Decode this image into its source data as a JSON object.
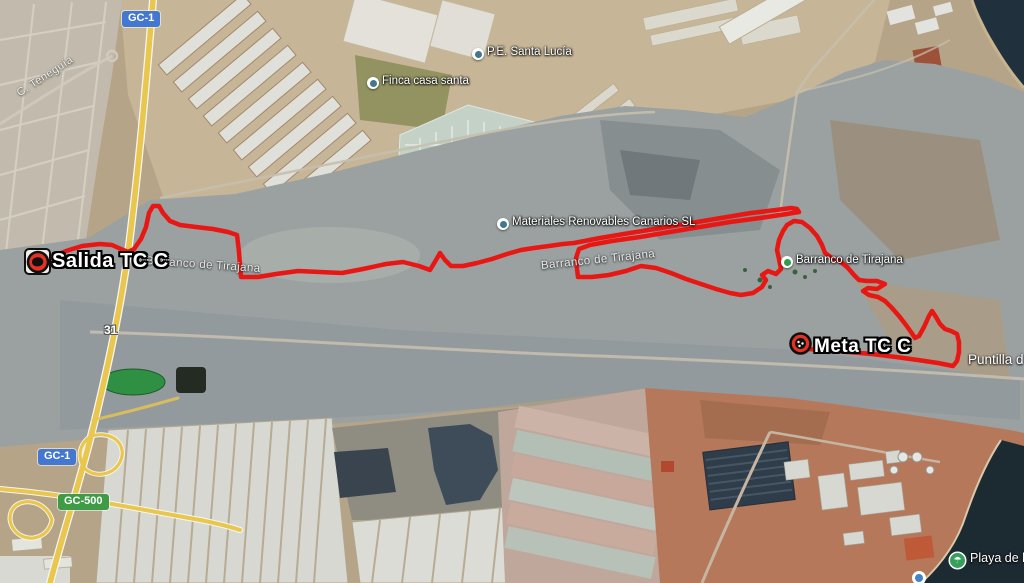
{
  "map": {
    "type": "satellite",
    "shields": {
      "gc1": "GC-1",
      "gc500": "GC-500"
    },
    "street_labels": {
      "teneguia": "C. Teneguía"
    },
    "exit_number": "31",
    "pois": [
      {
        "id": "pe_santa_lucia",
        "label": "P.E. Santa Lucía"
      },
      {
        "id": "finca_casa_santa",
        "label": "Finca casa santa"
      },
      {
        "id": "materiales",
        "label": "Materiales Renovables Canarios SL"
      },
      {
        "id": "barranco_poi",
        "label": "Barranco de Tirajana"
      },
      {
        "id": "playa",
        "label": "Playa de los"
      },
      {
        "id": "puntilla",
        "label": "Puntilla d"
      }
    ],
    "feature_labels": {
      "barranco_1": "Barranco de Tirajana",
      "barranco_2": "Barranco de Tirajana"
    },
    "markers": {
      "start": "Salida TC C",
      "finish": "Meta TC C"
    },
    "colors": {
      "route": "#e81713",
      "shield_gc1": "#4377d0",
      "shield_gc500": "#3f9b45",
      "poi_dot": "#41788c",
      "poi_dot_green": "#2f9e49"
    },
    "route": {
      "color": "#e81713",
      "points": [
        [
          50,
          258
        ],
        [
          66,
          251
        ],
        [
          82,
          246
        ],
        [
          100,
          244
        ],
        [
          112,
          245
        ],
        [
          121,
          249
        ],
        [
          128,
          252
        ],
        [
          134,
          249
        ],
        [
          141,
          239
        ],
        [
          146,
          227
        ],
        [
          149,
          213
        ],
        [
          153,
          206
        ],
        [
          159,
          206
        ],
        [
          163,
          213
        ],
        [
          170,
          221
        ],
        [
          180,
          225
        ],
        [
          196,
          227
        ],
        [
          213,
          229
        ],
        [
          228,
          232
        ],
        [
          237,
          235
        ],
        [
          239,
          252
        ],
        [
          240,
          265
        ],
        [
          241,
          277
        ],
        [
          258,
          277
        ],
        [
          276,
          274
        ],
        [
          298,
          271
        ],
        [
          320,
          272
        ],
        [
          342,
          273
        ],
        [
          363,
          269
        ],
        [
          386,
          264
        ],
        [
          403,
          262
        ],
        [
          419,
          266
        ],
        [
          430,
          270
        ],
        [
          436,
          260
        ],
        [
          440,
          253
        ],
        [
          445,
          260
        ],
        [
          451,
          266
        ],
        [
          463,
          266
        ],
        [
          477,
          263
        ],
        [
          492,
          259
        ],
        [
          507,
          254
        ],
        [
          521,
          250
        ],
        [
          534,
          248
        ],
        [
          549,
          246
        ],
        [
          563,
          244
        ],
        [
          574,
          243
        ],
        [
          600,
          238
        ],
        [
          630,
          233
        ],
        [
          661,
          228
        ],
        [
          691,
          223
        ],
        [
          721,
          218
        ],
        [
          751,
          213
        ],
        [
          776,
          210
        ],
        [
          791,
          208
        ],
        [
          797,
          209
        ],
        [
          799,
          212
        ],
        [
          787,
          214
        ],
        [
          760,
          218
        ],
        [
          730,
          222
        ],
        [
          700,
          227
        ],
        [
          670,
          232
        ],
        [
          640,
          237
        ],
        [
          612,
          241
        ],
        [
          590,
          245
        ],
        [
          579,
          249
        ],
        [
          576,
          258
        ],
        [
          577,
          269
        ],
        [
          578,
          277
        ],
        [
          592,
          277
        ],
        [
          609,
          275
        ],
        [
          626,
          271
        ],
        [
          641,
          266
        ],
        [
          656,
          268
        ],
        [
          671,
          273
        ],
        [
          686,
          279
        ],
        [
          701,
          284
        ],
        [
          716,
          289
        ],
        [
          730,
          293
        ],
        [
          741,
          295
        ],
        [
          753,
          293
        ],
        [
          762,
          287
        ],
        [
          766,
          280
        ],
        [
          762,
          275
        ],
        [
          768,
          271
        ],
        [
          776,
          274
        ],
        [
          781,
          269
        ],
        [
          779,
          259
        ],
        [
          777,
          250
        ],
        [
          779,
          240
        ],
        [
          783,
          231
        ],
        [
          787,
          225
        ],
        [
          794,
          221
        ],
        [
          802,
          222
        ],
        [
          810,
          228
        ],
        [
          817,
          236
        ],
        [
          822,
          245
        ],
        [
          825,
          253
        ],
        [
          832,
          258
        ],
        [
          841,
          262
        ],
        [
          848,
          268
        ],
        [
          854,
          275
        ],
        [
          859,
          280
        ],
        [
          867,
          281
        ],
        [
          877,
          281
        ],
        [
          885,
          284
        ],
        [
          877,
          289
        ],
        [
          868,
          288
        ],
        [
          863,
          291
        ],
        [
          869,
          295
        ],
        [
          878,
          297
        ],
        [
          885,
          301
        ],
        [
          892,
          308
        ],
        [
          899,
          316
        ],
        [
          906,
          325
        ],
        [
          911,
          332
        ],
        [
          915,
          338
        ],
        [
          919,
          336
        ],
        [
          924,
          327
        ],
        [
          929,
          316
        ],
        [
          932,
          311
        ],
        [
          936,
          317
        ],
        [
          940,
          324
        ],
        [
          945,
          329
        ],
        [
          951,
          331
        ],
        [
          957,
          334
        ],
        [
          959,
          342
        ],
        [
          959,
          352
        ],
        [
          957,
          361
        ],
        [
          953,
          366
        ],
        [
          938,
          363
        ],
        [
          918,
          360
        ],
        [
          896,
          357
        ],
        [
          872,
          354
        ],
        [
          848,
          352
        ],
        [
          824,
          350
        ],
        [
          808,
          349
        ]
      ]
    }
  }
}
